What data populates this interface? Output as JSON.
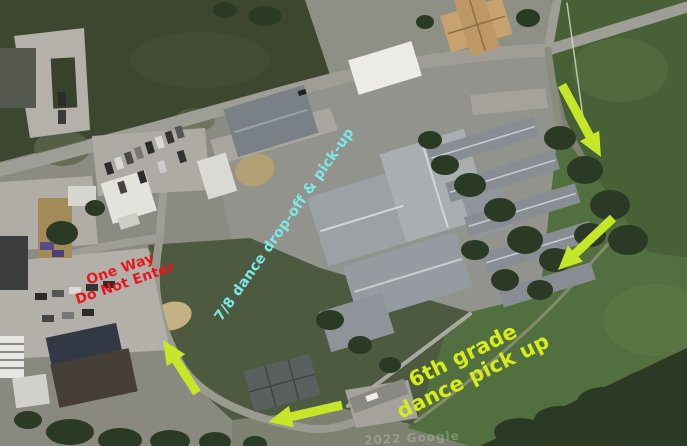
{
  "map": {
    "description": "Aerial satellite view of a school campus with dance drop-off and pick-up routes",
    "watermark": "2022 Google"
  },
  "annotations": {
    "labels": [
      {
        "id": "one-way-do-not-enter",
        "lines": [
          "One Way",
          "Do Not Enter"
        ],
        "color": "#e8151d",
        "x": 123,
        "y": 277,
        "rotation": -19,
        "font_size": 14
      },
      {
        "id": "dance-78-dropoff",
        "lines": [
          "7/8 dance drop-off & pick-up"
        ],
        "color": "#7de9e7",
        "x": 285,
        "y": 225,
        "rotation": -55,
        "font_size": 14
      },
      {
        "id": "dance-6th-pickup",
        "lines": [
          "6th grade",
          "dance pick up"
        ],
        "color": "#d6ec1e",
        "x": 468,
        "y": 366,
        "rotation": -26,
        "font_size": 21
      }
    ],
    "arrows": [
      {
        "id": "arrow-northeast-entrance",
        "x1": 562,
        "y1": 85,
        "x2": 601,
        "y2": 157,
        "color": "#c6e62a"
      },
      {
        "id": "arrow-east-drive",
        "x1": 613,
        "y1": 218,
        "x2": 558,
        "y2": 270,
        "color": "#c6e62a"
      },
      {
        "id": "arrow-south-loop",
        "x1": 342,
        "y1": 405,
        "x2": 268,
        "y2": 422,
        "color": "#c6e62a"
      },
      {
        "id": "arrow-west-loop",
        "x1": 197,
        "y1": 393,
        "x2": 163,
        "y2": 340,
        "color": "#c6e62a"
      }
    ]
  }
}
